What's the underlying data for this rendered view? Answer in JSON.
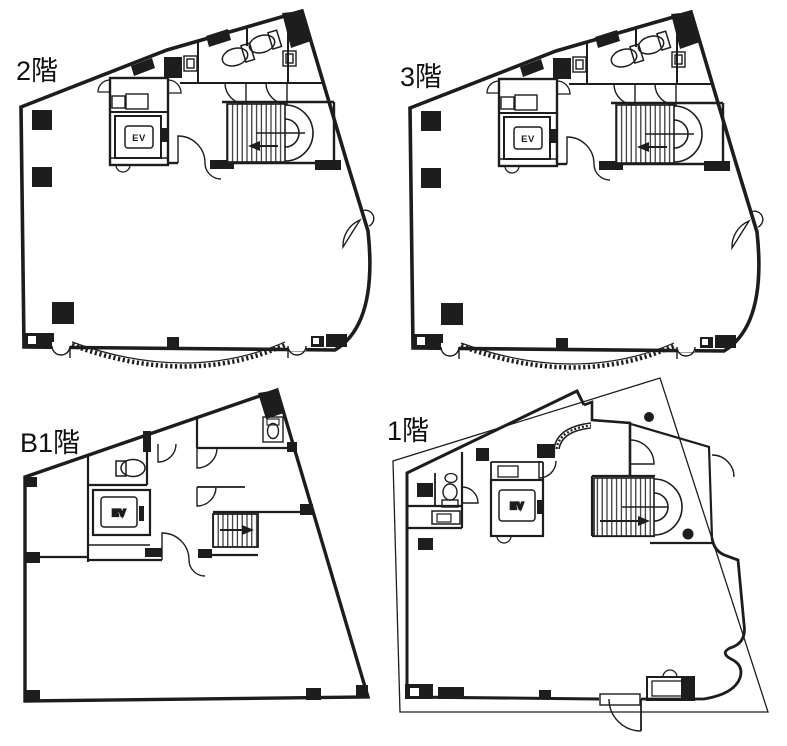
{
  "sheet": {
    "type": "building-floor-plan-sheet",
    "background_color": "#ffffff",
    "ink_color": "#1d1d1d"
  },
  "floors": [
    {
      "id": "2f",
      "label": "2階",
      "elevator_label": "EV"
    },
    {
      "id": "3f",
      "label": "3階",
      "elevator_label": "EV"
    },
    {
      "id": "b1",
      "label": "B1階",
      "elevator_label": "EV"
    },
    {
      "id": "1f",
      "label": "1階",
      "elevator_label": "EV"
    }
  ]
}
